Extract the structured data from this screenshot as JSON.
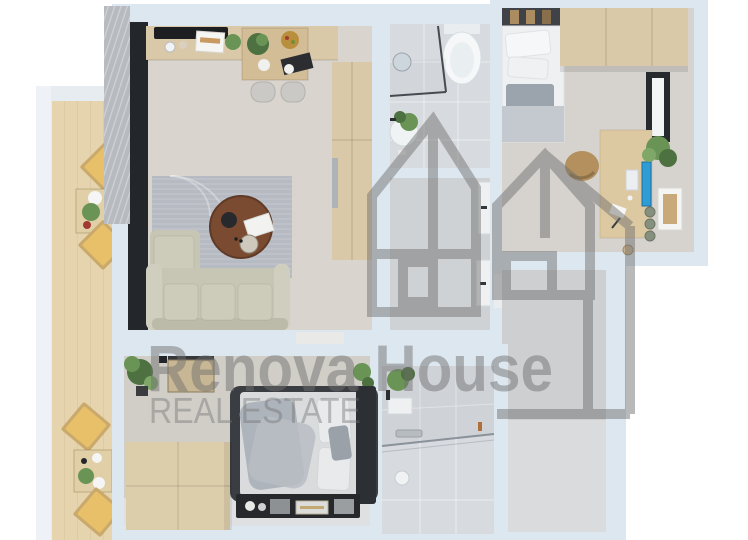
{
  "meta": {
    "type": "3d-rendered-floor-plan",
    "view": "top-down-apartment-render"
  },
  "watermark": {
    "brand": "Renova House",
    "tagline": "REAL ESTATE"
  },
  "colors": {
    "wall": "#dde7f0",
    "outside": "#ffffff",
    "floorLiving": "#d9d5ce",
    "floorBath": "#d7dade",
    "floorHall": "#cfd2d5",
    "floorBedRight": "#d6d3cf",
    "floorBedBottom": "#d1cec8",
    "floorEmptyWall": "#cdcfd0",
    "floorEmpty": "#d9dbdd",
    "woodDeck": "#e5d4ae",
    "woodCabinet": "#d9c9a8",
    "woodTable": "#d2bd97",
    "walnut": "#7a4a31",
    "sofa": "#c7c6b4",
    "rug": "#b6bac2",
    "glassDark": "#23262b",
    "curtain": "#b7bbc0",
    "cushionYellow": "#e7c069",
    "green": "#6a9455",
    "greenDark": "#4d7140",
    "bedFrame": "#3a3d42",
    "beddingWhite": "#eef0f2",
    "beddingGray": "#b5bbc2",
    "monitorBlue": "#2f9cd6",
    "consoleDark": "#26282c",
    "watermark": "#6f6f6f"
  },
  "rooms": [
    {
      "name": "living-room-kitchen",
      "furniture": [
        "kitchen counter with black cooktop",
        "dining table with two chairs",
        "tall cabinet with built-in oven",
        "striped area rug",
        "round walnut coffee table with decor",
        "L-shaped beige sofa",
        "floor-to-ceiling window with grey curtain",
        "door opening to bedroom"
      ]
    },
    {
      "name": "balcony",
      "furniture": [
        "wood decking",
        "four folding chairs with yellow cushions",
        "two small tables with plates and plants"
      ]
    },
    {
      "name": "bathroom-top",
      "furniture": [
        "toilet",
        "walk-in shower with glass screen",
        "round mirror",
        "round washbasin with plant"
      ]
    },
    {
      "name": "hallway",
      "furniture": [
        "two white interior doors with dark handles"
      ]
    },
    {
      "name": "bedroom-right",
      "furniture": [
        "double bed with white and grey bedding",
        "headboard shelf with wood slats",
        "light-wood wardrobe",
        "desk with blue monitor and accessories",
        "tan desk chair",
        "potted plant",
        "leaning picture frame",
        "black-framed window"
      ]
    },
    {
      "name": "bedroom-bottom",
      "furniture": [
        "double bed with dark frame and grey throw",
        "low light-wood wardrobe block",
        "dark media console with decor objects",
        "potted plants",
        "wall-mounted shelf box"
      ]
    },
    {
      "name": "bathroom-bottom",
      "furniture": [
        "walk-in shower with glass screen and drain",
        "shelf with trailing plant",
        "shower head",
        "towel hook"
      ]
    },
    {
      "name": "empty-room-bottom-right",
      "furniture": []
    }
  ]
}
